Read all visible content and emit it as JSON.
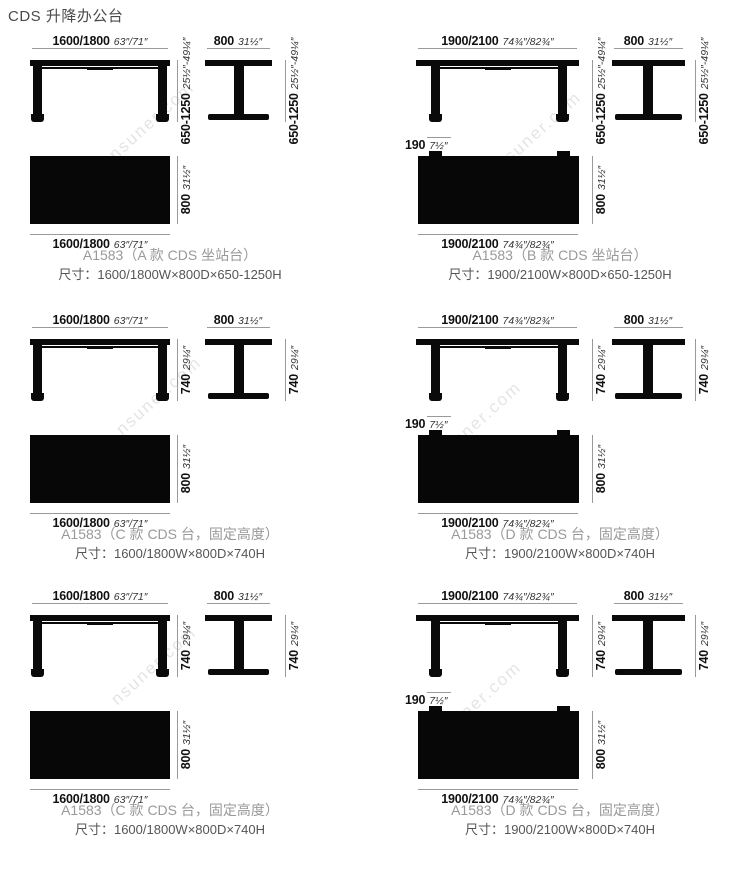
{
  "page": {
    "title": "CDS 升降办公台",
    "watermark": "nsuner.com",
    "ink_color": "#0a0a0a",
    "dim_line_color": "#9a9a9a",
    "caption_color": "#999999",
    "size_text_color": "#555555"
  },
  "panels": [
    {
      "id": "A",
      "width_mm": "1600/1800",
      "width_in": "63″/71″",
      "depth_mm": "800",
      "depth_in": "31½″",
      "height_mm": "650-1250",
      "height_in": "25½″-49¼″",
      "caption": "A1583（A 款 CDS 坐站台）",
      "size_line": "尺寸：1600/1800W×800D×650-1250H"
    },
    {
      "id": "B",
      "width_mm": "1900/2100",
      "width_in": "74¾″/82¾″",
      "depth_mm": "800",
      "depth_in": "31½″",
      "height_mm": "650-1250",
      "height_in": "25½″-49¼″",
      "overhang_mm": "190",
      "overhang_in": "7½″",
      "caption": "A1583（B 款 CDS 坐站台）",
      "size_line": "尺寸：1900/2100W×800D×650-1250H"
    },
    {
      "id": "C",
      "width_mm": "1600/1800",
      "width_in": "63″/71″",
      "depth_mm": "800",
      "depth_in": "31½″",
      "height_mm": "740",
      "height_in": "29¼″",
      "caption": "A1583（C 款 CDS 台，固定高度）",
      "size_line": "尺寸：1600/1800W×800D×740H"
    },
    {
      "id": "D",
      "width_mm": "1900/2100",
      "width_in": "74¾″/82¾″",
      "depth_mm": "800",
      "depth_in": "31½″",
      "height_mm": "740",
      "height_in": "29¼″",
      "overhang_mm": "190",
      "overhang_in": "7½″",
      "caption": "A1583（D 款 CDS 台，固定高度）",
      "size_line": "尺寸：1900/2100W×800D×740H"
    },
    {
      "id": "C2",
      "width_mm": "1600/1800",
      "width_in": "63″/71″",
      "depth_mm": "800",
      "depth_in": "31½″",
      "height_mm": "740",
      "height_in": "29¼″",
      "caption": "A1583（C 款 CDS 台，固定高度）",
      "size_line": "尺寸：1600/1800W×800D×740H"
    },
    {
      "id": "D2",
      "width_mm": "1900/2100",
      "width_in": "74¾″/82¾″",
      "depth_mm": "800",
      "depth_in": "31½″",
      "height_mm": "740",
      "height_in": "29¼″",
      "overhang_mm": "190",
      "overhang_in": "7½″",
      "caption": "A1583（D 款 CDS 台，固定高度）",
      "size_line": "尺寸：1900/2100W×800D×740H"
    }
  ]
}
